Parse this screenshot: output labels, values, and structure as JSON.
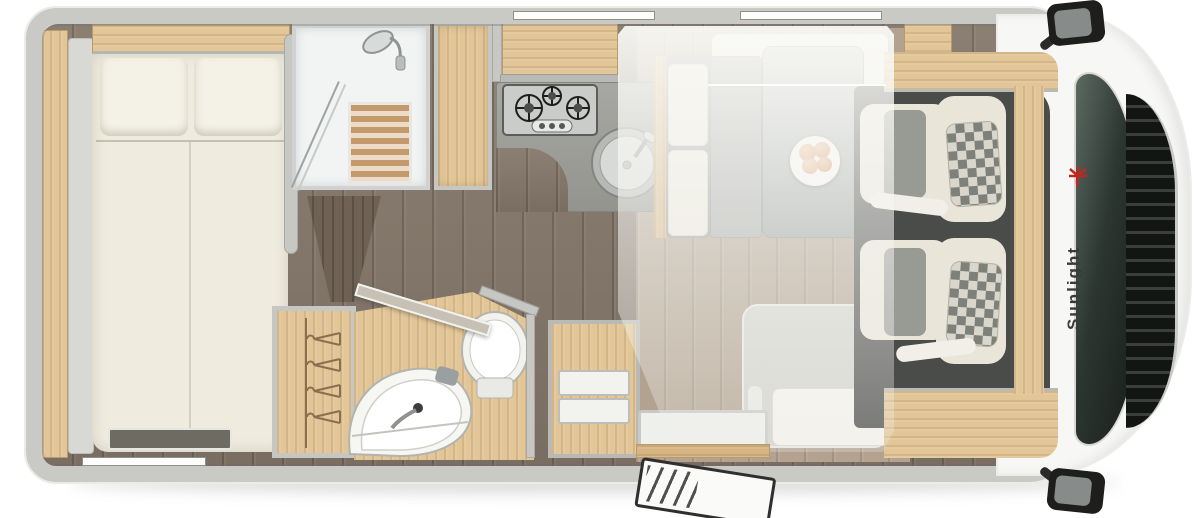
{
  "meta": {
    "view": "motorhome-floorplan-top-view"
  },
  "brand": {
    "name": "Sunlight"
  },
  "colors": {
    "background": "#ffffff",
    "wall_grey": "#c7c7c4",
    "body_white": "#f7f7f5",
    "wood_light": "#e2c697",
    "wood_mid": "#d6b583",
    "floor_dark_wood": "#84776a",
    "floor_dinette": "#b2a28f",
    "upholstery_cream": "#e9e6d9",
    "counter_grey": "#9c9c98",
    "table_grey": "#a3a8a5",
    "cab_floor": "#4a4c49",
    "windshield_glass": "#2c3631",
    "logo_red": "#c0271f",
    "logo_text": "#3a3a38"
  },
  "fixtures": [
    "rear-bed",
    "bed-pillows",
    "rear-shelf",
    "overhead-locker",
    "shower",
    "shower-duckboard",
    "tall-cabinet",
    "kitchen-overhead-locker",
    "kitchen-hob",
    "kitchen-sink",
    "kitchen-counter",
    "bathroom",
    "toilet",
    "washbasin",
    "bathroom-door",
    "wardrobe-with-hangers",
    "drawer-cabinet",
    "dinette-table",
    "dinette-bench",
    "side-seat",
    "plate-of-food",
    "drop-down-bed-overlay",
    "entry-door",
    "entry-step",
    "cab-floor",
    "cab-seat-top",
    "cab-seat-bottom",
    "windshield",
    "front-grille",
    "side-mirror-top",
    "side-mirror-bottom"
  ]
}
